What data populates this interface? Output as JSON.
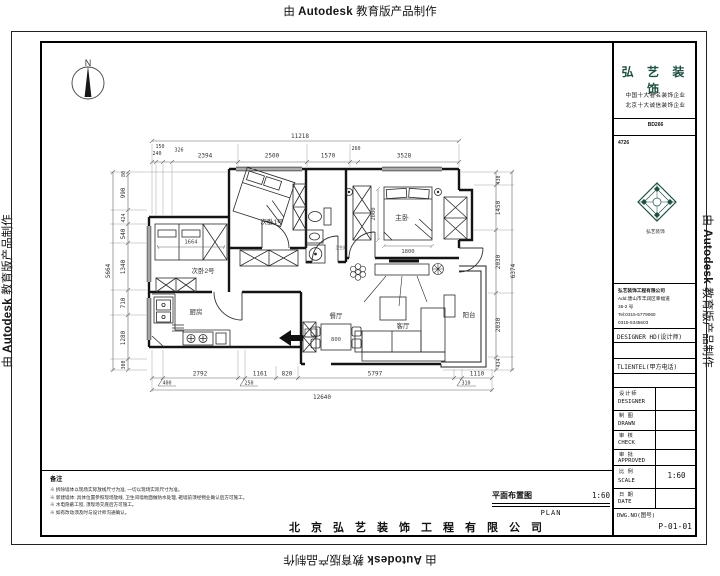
{
  "colors": {
    "brand_green": "#1f4f43",
    "line": "#1a1a1a",
    "dim": "#666666"
  },
  "watermark": {
    "prefix": "由",
    "brand": "Autodesk",
    "suffix": "教育版产品制作"
  },
  "compass": {
    "label": "N"
  },
  "rooms": {
    "bedroom1": "次卧1号",
    "bedroom2": "次卧2号",
    "kitchen": "厨房",
    "dining": "餐厅",
    "living": "客厅",
    "master": "主卧",
    "bath": "卫生间",
    "balcony": "阳台"
  },
  "furn_dims": {
    "wardrobe": "1664",
    "bed_width": "1800",
    "bed_length": "2000",
    "table": "800"
  },
  "dims": {
    "top": {
      "total": "11218",
      "segments": [
        "150",
        "240",
        "326",
        "2394",
        "2500",
        "1570",
        "260",
        "3528"
      ]
    },
    "left": {
      "total": "5664",
      "segments": [
        "80",
        "990",
        "424",
        "540",
        "1340",
        "710",
        "1280",
        "300"
      ]
    },
    "bottom": {
      "total": "12640",
      "segments": [
        "400",
        "2792",
        "250",
        "1161",
        "820",
        "5797",
        "310",
        "1110"
      ]
    },
    "right": {
      "total": "6374",
      "segments": [
        "430",
        "1450",
        "2030",
        "2030",
        "434"
      ]
    }
  },
  "notes": {
    "title": "备注",
    "items": [
      "※ 拆除墙体以现场实际放线尺寸为准, 一切以现场实际尺寸为准。",
      "※ 新建墙体: 具体位置参照现场放线, 卫生间墙地面做防水处理, 砸墙前须经物业确认后方可施工。",
      "※ 水电隐蔽工程, 须现场交底后方可施工。",
      "※ 如有改动须及时与设计师沟通确认。"
    ]
  },
  "footer": {
    "title": "平面布置图",
    "scale": "1:60",
    "subtitle": "PLAN",
    "company": "北京弘艺装饰工程有限公司"
  },
  "title_block": {
    "brand": "弘 艺 装 饰",
    "subtitle1": "中国十大著名装饰企业",
    "subtitle2": "北京十大诚信装饰企业",
    "cert1": "BD266",
    "cert2": "4726",
    "logo_caption": "弘艺装饰",
    "company_line": "弘艺装饰工程有限公司",
    "address1": "Add:唐山市丰润区幸福道",
    "address2": "36-2 号",
    "phone1": "Tel:0315-5779060",
    "phone2": "0315-5345603",
    "designer_line": "DESIGNER HD(设计师)",
    "client_line": "TLIENTEL(甲方电话)",
    "rows": [
      {
        "cn": "设计师",
        "en": "DESIGNER",
        "value": ""
      },
      {
        "cn": "制 图",
        "en": "DRAWN",
        "value": ""
      },
      {
        "cn": "审 核",
        "en": "CHECK",
        "value": ""
      },
      {
        "cn": "审 批",
        "en": "APPROVED",
        "value": ""
      },
      {
        "cn": "比 例",
        "en": "SCALE",
        "value": "1:60"
      },
      {
        "cn": "日 期",
        "en": "DATE",
        "value": ""
      }
    ],
    "dwg_label": "DWG.NO(图号)",
    "dwg_no": "P-01-01"
  }
}
